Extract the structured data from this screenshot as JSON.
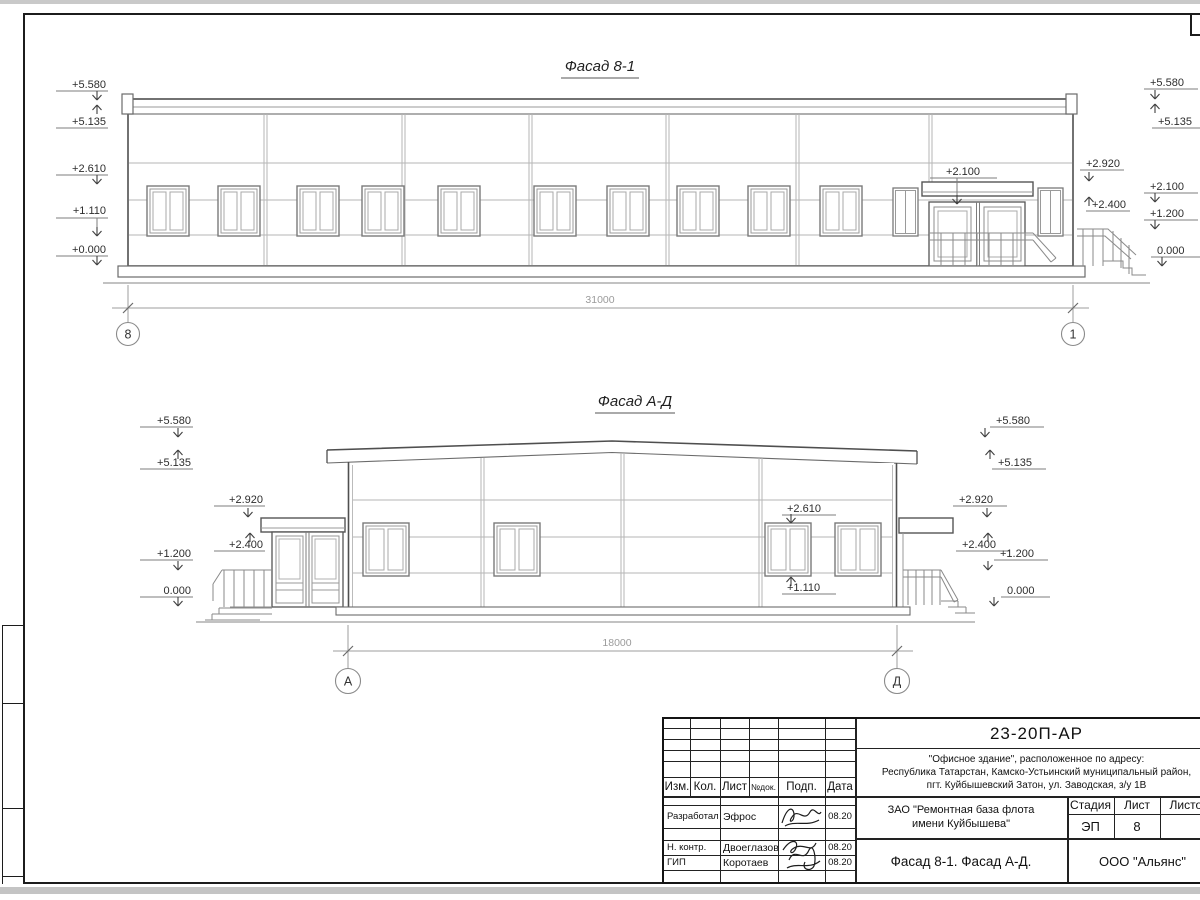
{
  "marks": {
    "p5580": "+5.580",
    "p5135": "+5.135",
    "p2920": "+2.920",
    "p2610": "+2.610",
    "p2400": "+2.400",
    "p2100": "+2.100",
    "p1200": "+1.200",
    "p1110": "+1.110",
    "p0000": "+0.000",
    "zero": "0.000"
  },
  "facade1": {
    "title": "Фасад 8-1",
    "dimension": "31000",
    "axis_left": "8",
    "axis_right": "1",
    "canopy_mark": "+2.100"
  },
  "facade2": {
    "title": "Фасад А-Д",
    "dimension": "18000",
    "axis_left": "А",
    "axis_right": "Д",
    "window_mark_top": "+2.610",
    "window_mark_bottom": "+1.110"
  },
  "title_block": {
    "doc_number": "23-20П-АР",
    "address_lines": [
      "\"Офисное здание\", расположенное по адресу:",
      "Республика Татарстан, Камско-Устьинский муниципальный район,",
      "пгт. Куйбышевский Затон, ул. Заводская, з/у 1В"
    ],
    "client_lines": [
      "ЗАО \"Ремонтная база флота",
      "имени Куйбышева\""
    ],
    "headers": {
      "izm": "Изм.",
      "kol": "Кол.",
      "list": "Лист",
      "ndok": "№док.",
      "podp": "Подп.",
      "data": "Дата"
    },
    "staff": [
      {
        "role": "Разработал",
        "name": "Эфрос",
        "date": "08.20"
      },
      {
        "role": "Н. контр.",
        "name": "Двоеглазов",
        "date": "08.20"
      },
      {
        "role": "ГИП",
        "name": "Коротаев",
        "date": "08.20"
      }
    ],
    "stage_label": "Стадия",
    "sheet_label": "Лист",
    "sheets_label": "Листов",
    "stage": "ЭП",
    "sheet_no": "8",
    "sheet_title": "Фасад 8-1. Фасад А-Д.",
    "firm": "ООО \"Альянс\""
  }
}
